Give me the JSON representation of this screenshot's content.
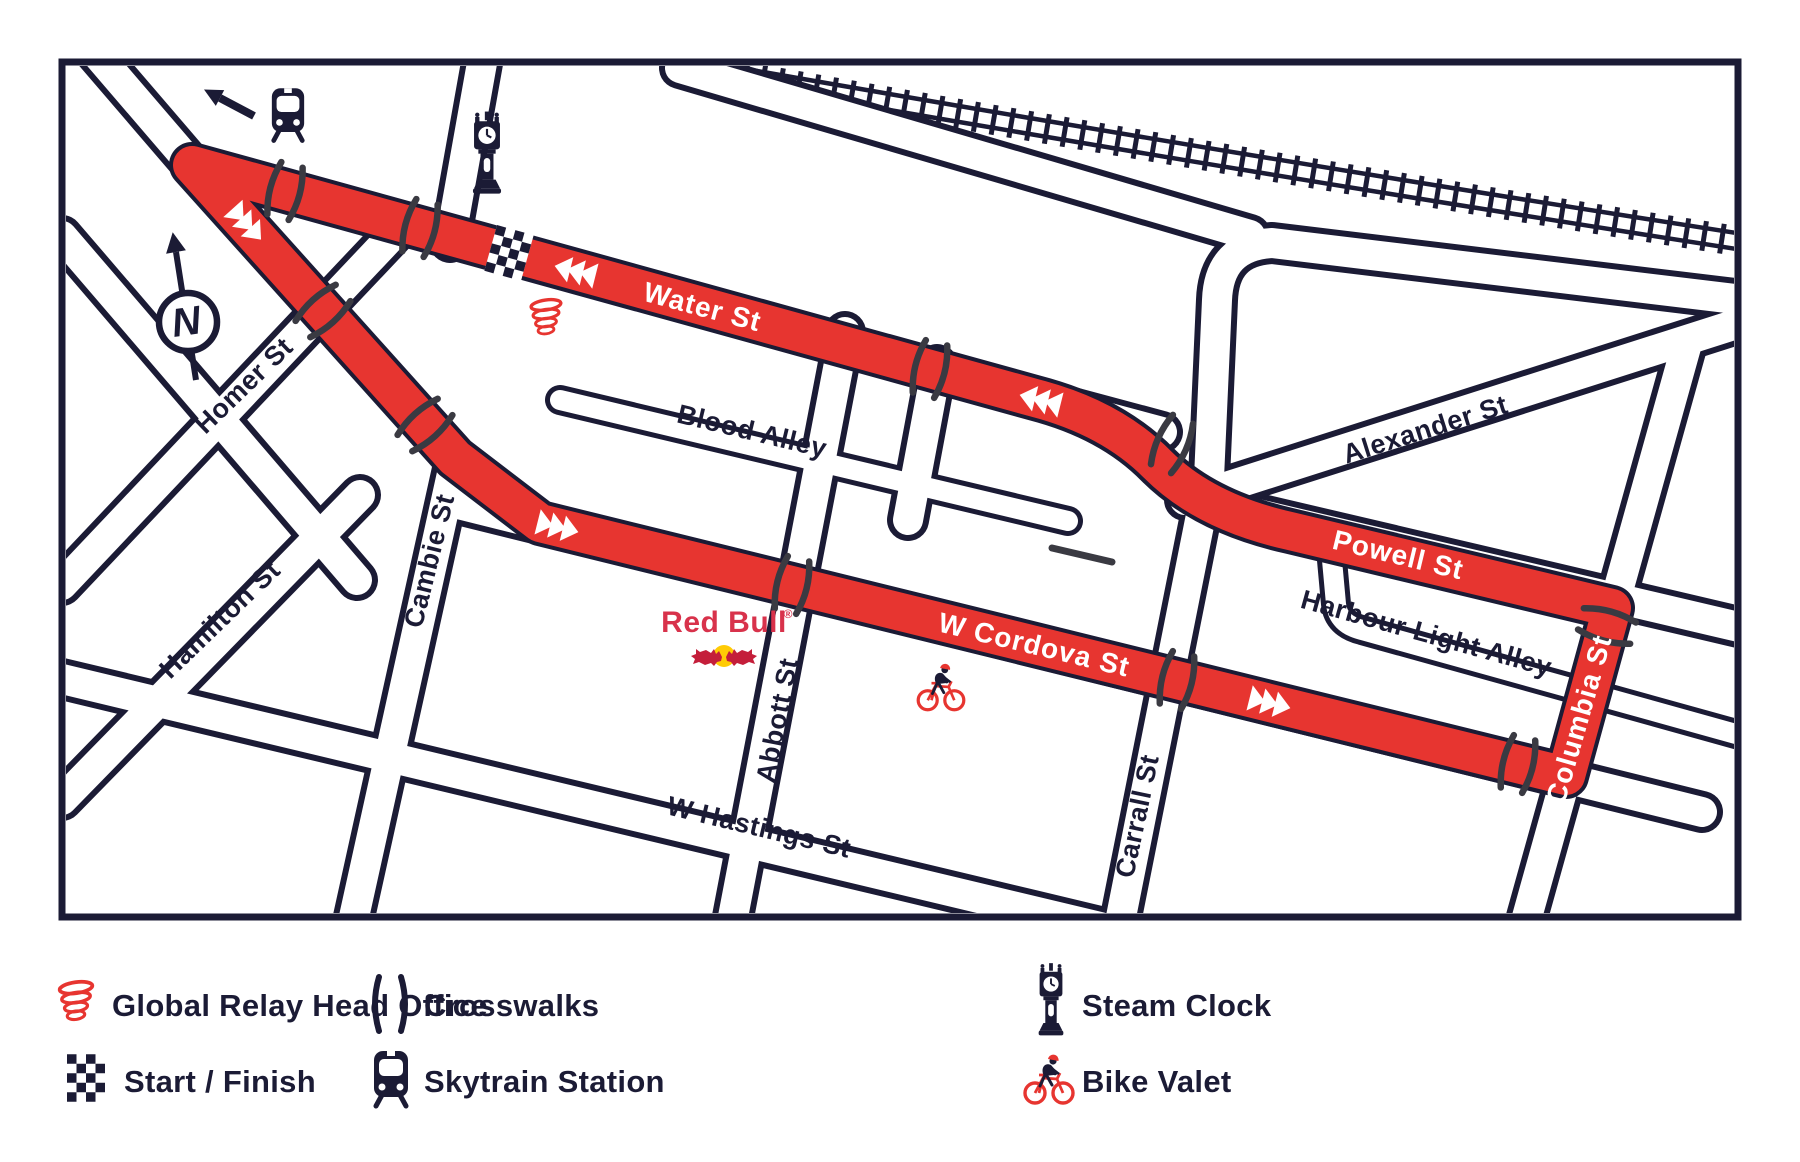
{
  "map": {
    "street_labels": {
      "water": "Water St",
      "cordova": "W Cordova St",
      "powell": "Powell St",
      "columbia": "Columbia St",
      "alexander": "Alexander St",
      "blood_alley": "Blood Alley",
      "harbour_light_alley": "Harbour Light Alley",
      "hastings": "W Hastings St",
      "homer": "Homer St",
      "hamilton": "Hamilton St",
      "cambie": "Cambie St",
      "abbott": "Abbott St",
      "carrall": "Carrall St"
    },
    "compass_label": "N",
    "sponsor": {
      "wordmark": "Red Bull",
      "registered_mark": "®"
    },
    "colors": {
      "route_red": "#e73530",
      "line_navy": "#1b1b35",
      "crosswalk_gray": "#3a3a42",
      "redbull_text": "#d8324b",
      "redbull_bull": "#c41e3a",
      "redbull_sun": "#ffcb05"
    }
  },
  "legend": {
    "items": [
      {
        "icon": "global-relay-swirl-icon",
        "label": "Global Relay Head Office"
      },
      {
        "icon": "crosswalks-icon",
        "label": "Crosswalks"
      },
      {
        "icon": "steam-clock-icon",
        "label": "Steam Clock"
      },
      {
        "icon": "start-finish-checker-icon",
        "label": "Start / Finish"
      },
      {
        "icon": "skytrain-station-icon",
        "label": "Skytrain Station"
      },
      {
        "icon": "bike-valet-icon",
        "label": "Bike Valet"
      }
    ]
  }
}
